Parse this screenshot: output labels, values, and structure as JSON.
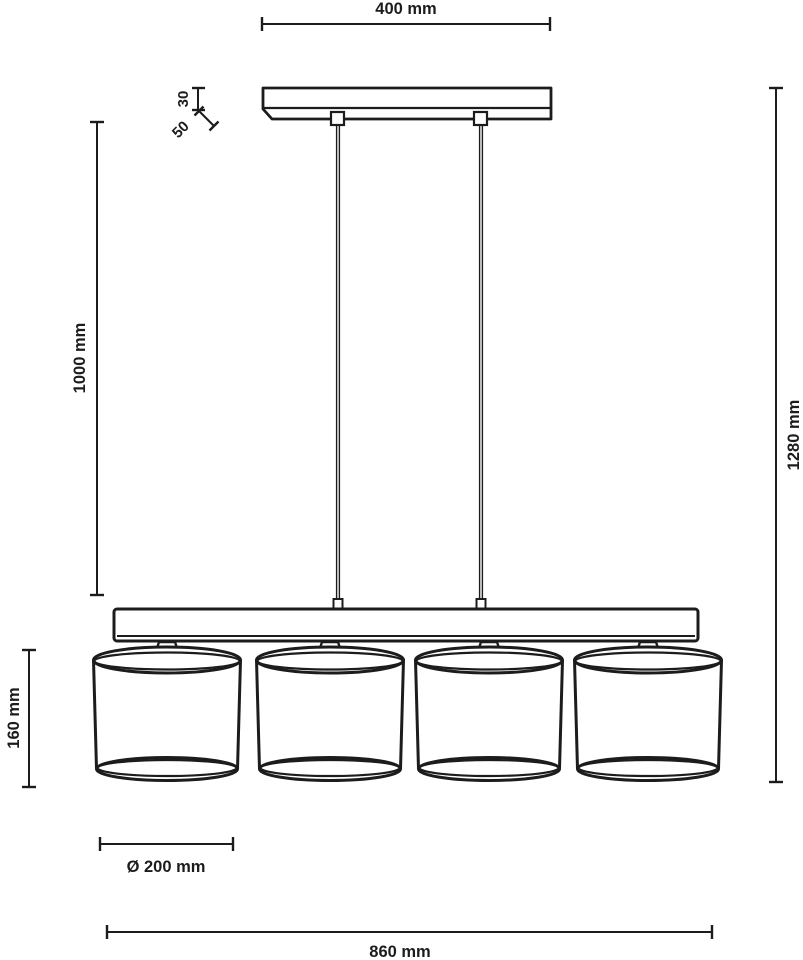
{
  "diagram": {
    "type": "dimensioned technical line drawing",
    "subject": "linear pendant lamp: ceiling canopy, two suspension cables, horizontal beam with four drum shades",
    "ink_color": "#1c1c1c",
    "background_color": "#ffffff",
    "shade_count": 4,
    "dimensions": {
      "canopy_width": "400 mm",
      "canopy_height": "30",
      "canopy_total_height": "50",
      "suspension_length": "1000 mm",
      "overall_height": "1280 mm",
      "shade_height": "160 mm",
      "shade_diameter": "Ø 200 mm",
      "fixture_length": "860 mm"
    }
  }
}
